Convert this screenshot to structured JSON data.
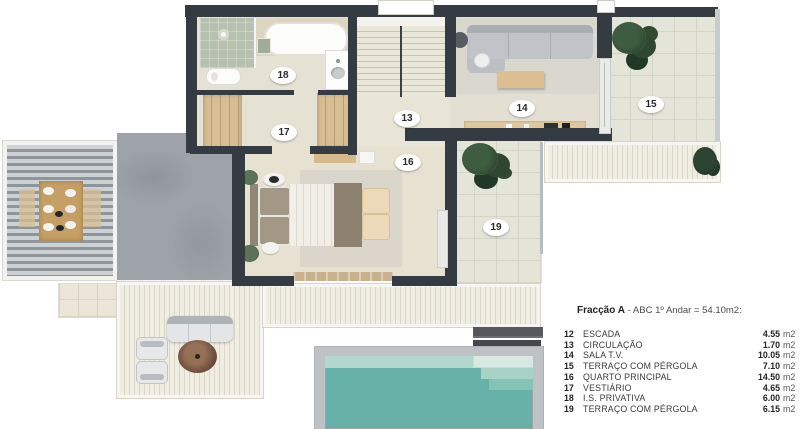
{
  "legend": {
    "title_bold": "Fracção A",
    "title_rest": " - ABC 1º Andar = 54.10m2:",
    "rows": [
      {
        "num": "12",
        "name": "ESCADA",
        "value": "4.55",
        "unit": "m2"
      },
      {
        "num": "13",
        "name": "CIRCULAÇÃO",
        "value": "1.70",
        "unit": "m2"
      },
      {
        "num": "14",
        "name": "SALA T.V.",
        "value": "10.05",
        "unit": "m2"
      },
      {
        "num": "15",
        "name": "TERRAÇO COM PÉRGOLA",
        "value": "7.10",
        "unit": "m2"
      },
      {
        "num": "16",
        "name": "QUARTO PRINCIPAL",
        "value": "14.50",
        "unit": "m2"
      },
      {
        "num": "17",
        "name": "VESTIÁRIO",
        "value": "4.65",
        "unit": "m2"
      },
      {
        "num": "18",
        "name": "I.S. PRIVATIVA",
        "value": "6.00",
        "unit": "m2"
      },
      {
        "num": "19",
        "name": "TERRAÇO COM PÉRGOLA",
        "value": "6.15",
        "unit": "m2"
      }
    ]
  },
  "plan": {
    "labels": [
      {
        "id": "18",
        "text": "18"
      },
      {
        "id": "17",
        "text": "17"
      },
      {
        "id": "13",
        "text": "13"
      },
      {
        "id": "16",
        "text": "16"
      },
      {
        "id": "14",
        "text": "14"
      },
      {
        "id": "15",
        "text": "15"
      },
      {
        "id": "19",
        "text": "19"
      }
    ]
  },
  "palette": {
    "wall": "#353b42",
    "interior_floor": "#e6e2d3",
    "terrace_tile": "#e4e5d8",
    "deck": "#f0ede3",
    "patio_concrete": "#9da3a8",
    "pool_water": "#68b1a8",
    "pool_rim": "#bfc2c4",
    "wood": "#d8be93",
    "plant_green": "#2f4731"
  }
}
